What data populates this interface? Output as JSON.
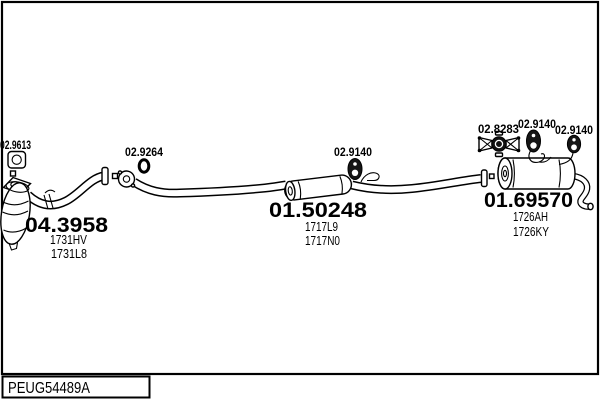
{
  "document": {
    "code": "PEUG54489A"
  },
  "colors": {
    "line": "#000000",
    "background": "#ffffff"
  },
  "parts": {
    "gasket": {
      "label": "02.9613"
    },
    "clamp": {
      "label": "02.9264"
    },
    "catalyst": {
      "number": "04.3958",
      "codes": [
        "1731HV",
        "1731L8"
      ]
    },
    "centre_silencer": {
      "number": "01.50248",
      "codes": [
        "1717L9",
        "1717N0"
      ],
      "hanger": "02.9140"
    },
    "bracket": {
      "label": "02.8283"
    },
    "rear_silencer": {
      "number": "01.69570",
      "codes": [
        "1726AH",
        "1726KY"
      ],
      "hangers": [
        "02.9140",
        "02.9140"
      ]
    }
  },
  "icons": {
    "gasket_icon": "square-flange-gasket",
    "clamp_icon": "pipe-clamp-ring",
    "rubber_hanger_icon": "rubber-mount",
    "bracket_icon": "mounting-bracket"
  }
}
